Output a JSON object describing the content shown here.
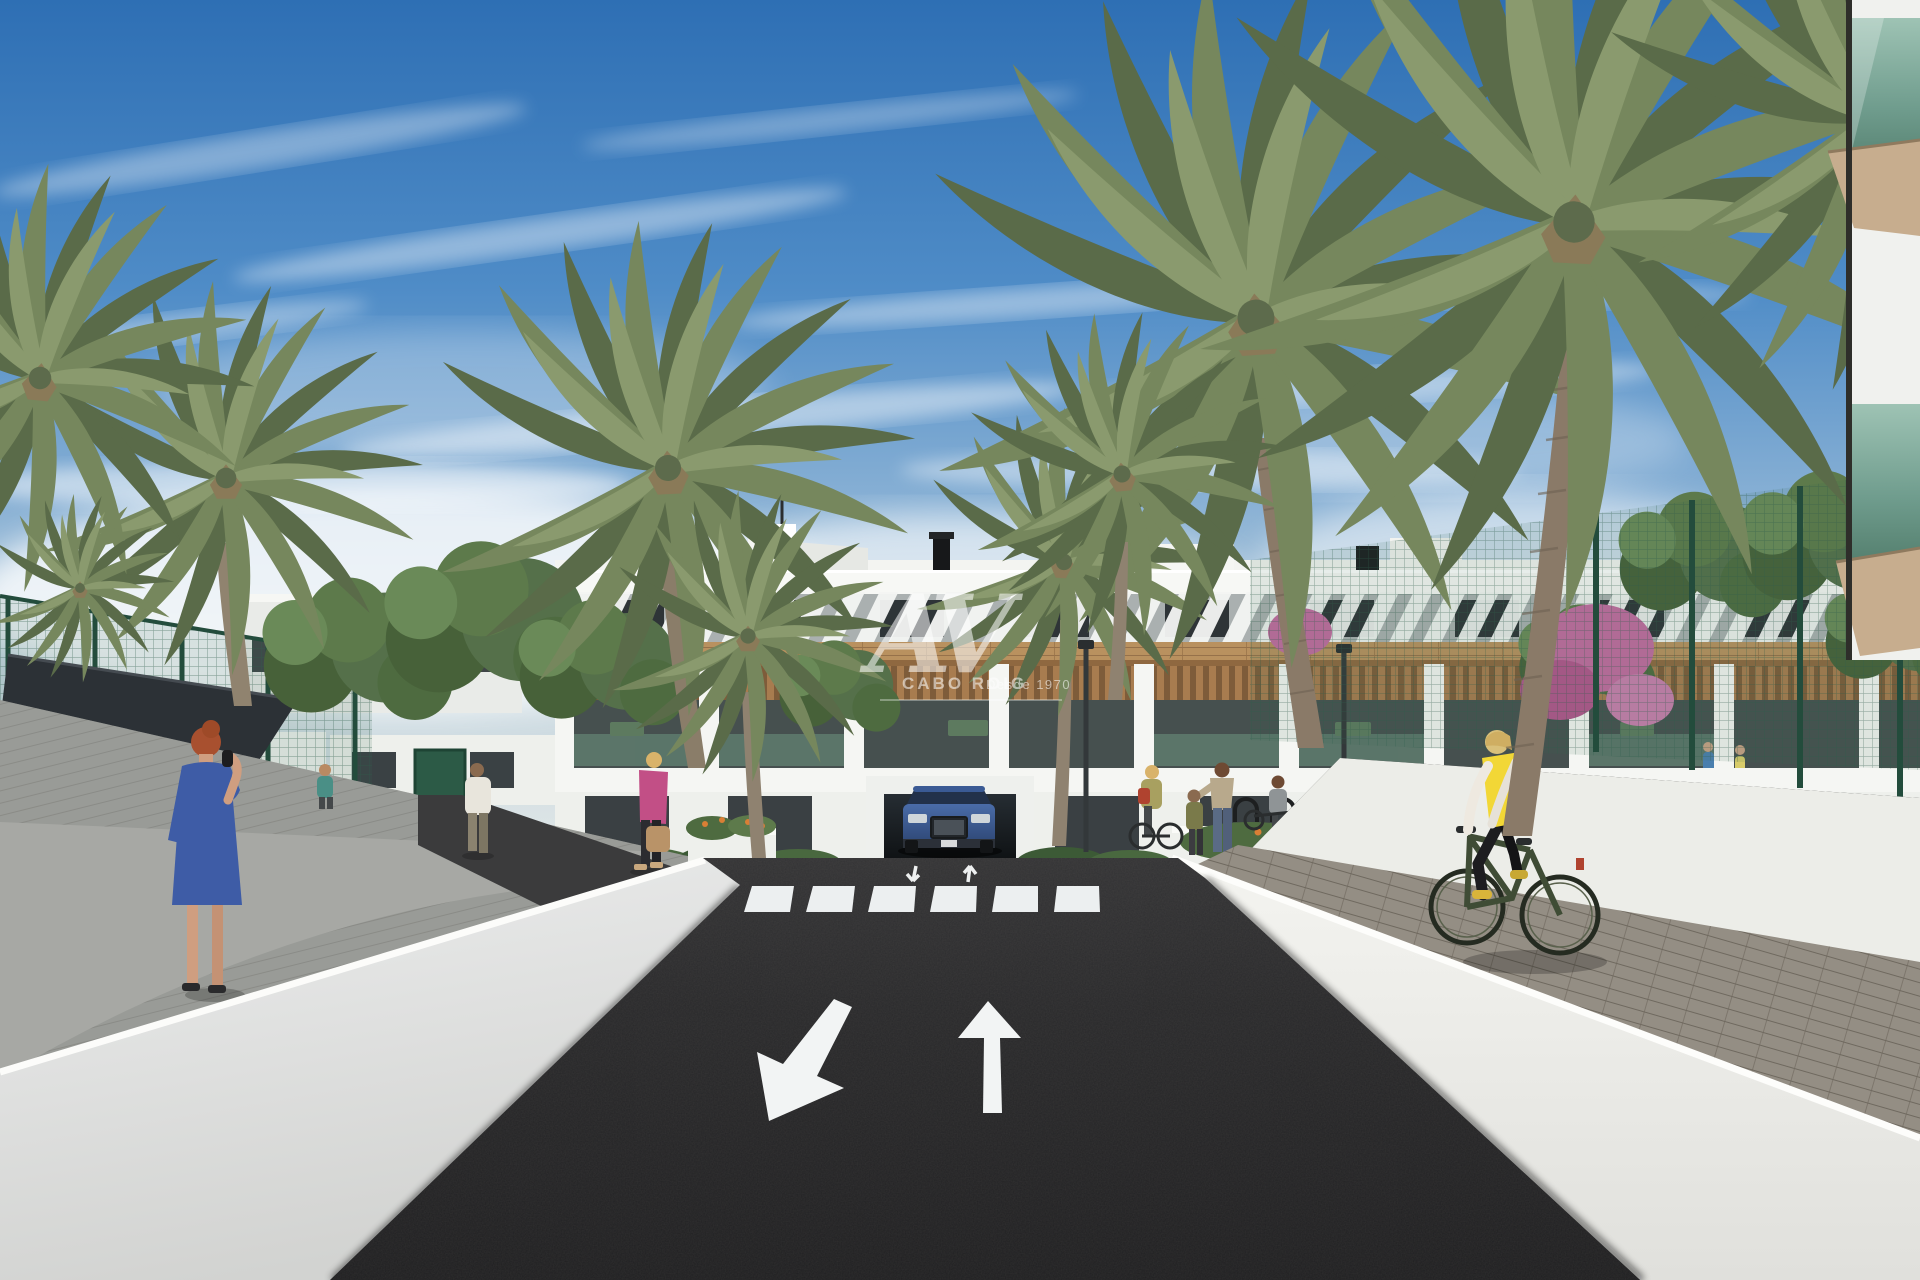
{
  "scene": {
    "kind": "architectural-render",
    "width_px": 1920,
    "height_px": 1280
  },
  "watermark": {
    "monogram": "AV",
    "brand": "CABO ROIG",
    "tagline": "Desde 1970",
    "color": "#ffffff"
  },
  "road_markings": {
    "left_lane_arrow": "arrow-down-left",
    "right_lane_arrow": "arrow-up",
    "near_crosswalk_arrows": [
      "arrow-down-small",
      "arrow-up-small"
    ],
    "crosswalk_stripe_count": 6,
    "marking_color": "#f2f4f4"
  },
  "palette": {
    "sky_top": "#2e6fb4",
    "sky_mid": "#7fa9d2",
    "sky_horizon": "#e3e9ea",
    "cloud_white": "#ffffff",
    "asphalt_dark": "#252527",
    "walkway_gray": "#9a9b97",
    "paver_gray": "#948e84",
    "wall_white": "#f0f1ed",
    "building_white": "#f3f4f1",
    "window_dark": "#343b3e",
    "wood_cladding": "#b9915f",
    "palm_green": "#76875d",
    "tree_green": "#4e6b40",
    "fence_green": "#2f5d4b",
    "shade_sail": "#2c3136",
    "flower_pink": "#c26ba0",
    "flower_orange": "#d97f35",
    "car_blue": "#3c5e9e",
    "vest_yellow": "#f2d736",
    "dress_blue": "#3e5ca6",
    "jacket_pink": "#c24f86",
    "balcony_glass_green": "#7fae9b"
  }
}
